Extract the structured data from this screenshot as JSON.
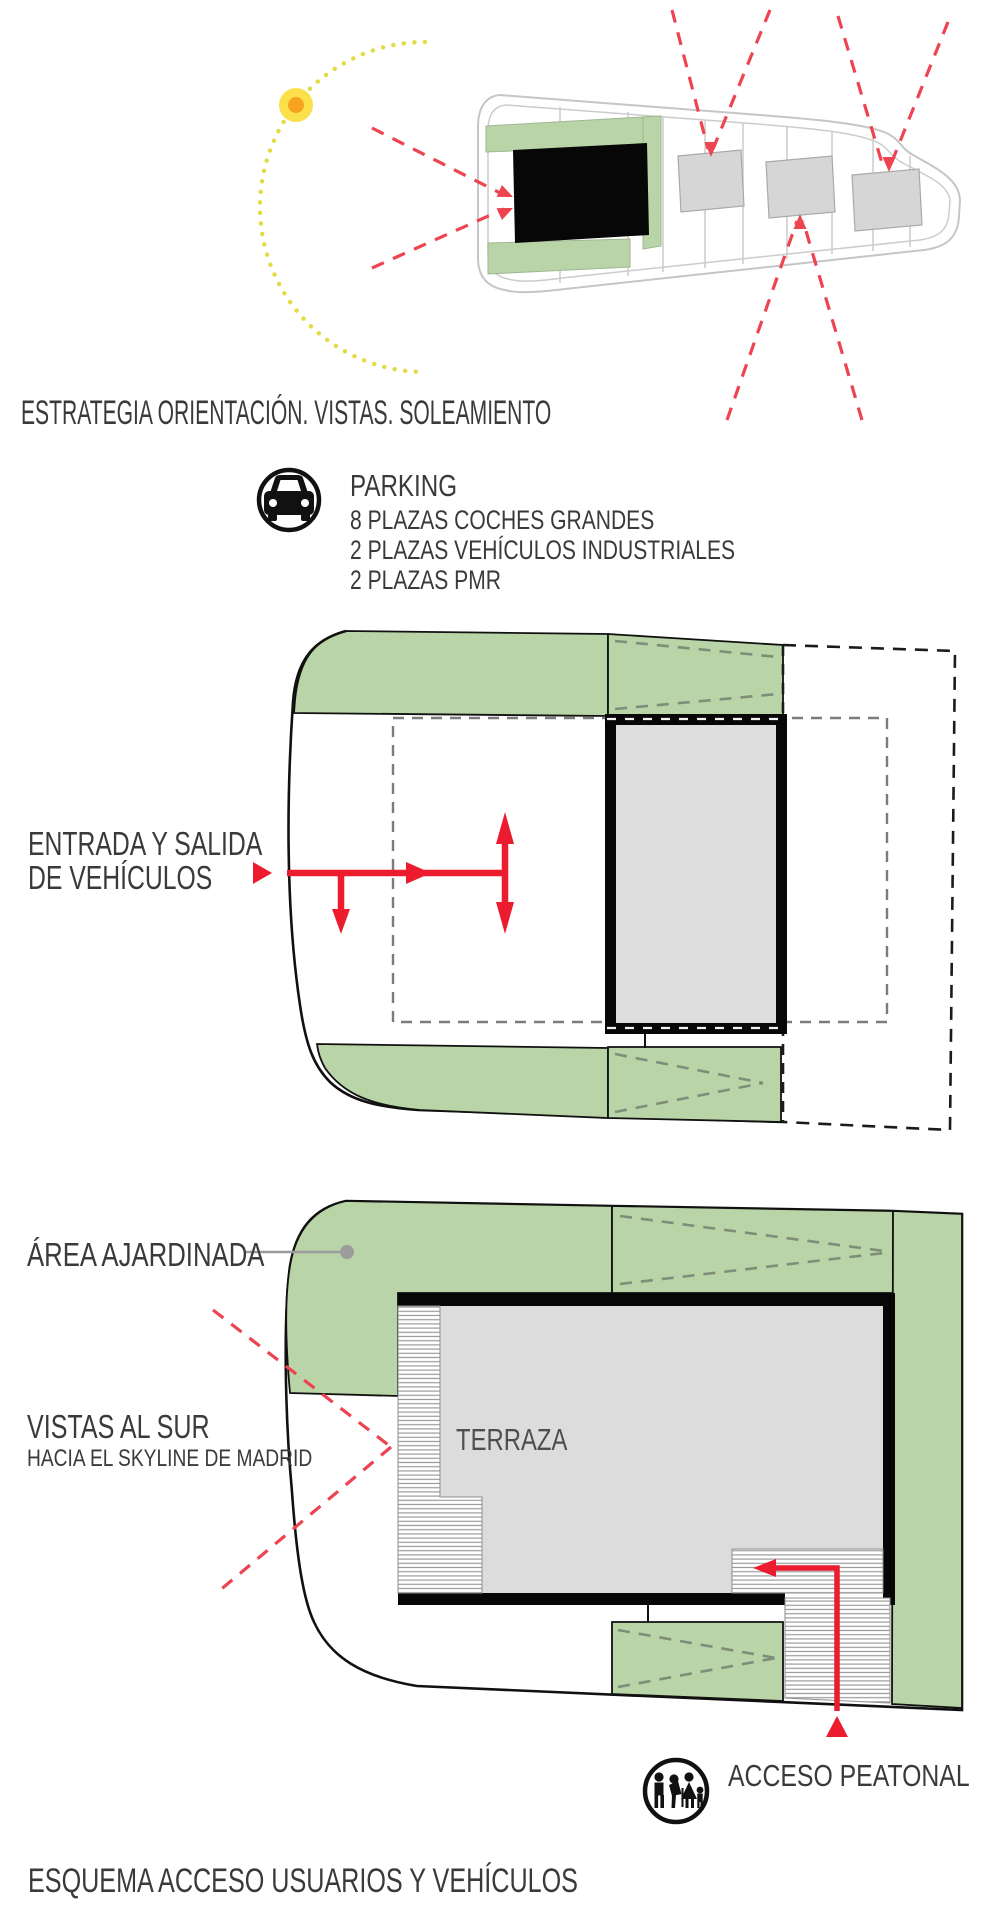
{
  "section_orientation": {
    "title": "ESTRATEGIA ORIENTACIÓN. VISTAS. SOLEAMIENTO"
  },
  "parking": {
    "title": "PARKING",
    "lines": [
      "8 PLAZAS COCHES GRANDES",
      "2 PLAZAS VEHÍCULOS INDUSTRIALES",
      "2 PLAZAS PMR"
    ],
    "icon": "car-icon"
  },
  "section_access": {
    "vehicle_label_line1": "ENTRADA Y SALIDA",
    "vehicle_label_line2": "DE VEHÍCULOS",
    "garden_label": "ÁREA AJARDINADA",
    "views_label_line1": "VISTAS AL SUR",
    "views_label_line2": "HACIA EL SKYLINE DE MADRID",
    "terrace_label": "TERRAZA",
    "pedestrian_label": "ACCESO PEATONAL",
    "pedestrian_icon": "family-pedestrians-icon",
    "footer_title": "ESQUEMA ACCESO USUARIOS Y VEHÍCULOS"
  },
  "colors": {
    "green_area": "#B9D5A7",
    "red_arrow": "#EC1C2E",
    "red_dashed": "#EE4350",
    "sun_yellow": "#FBE04B",
    "sun_core_orange": "#F6A41F",
    "sun_path_yellow": "#E2DB43",
    "building_gray": "#DCDCDC",
    "building_black": "#070707",
    "text_gray": "#3A3A3A",
    "chevron_green_gray": "#7E8E78"
  }
}
